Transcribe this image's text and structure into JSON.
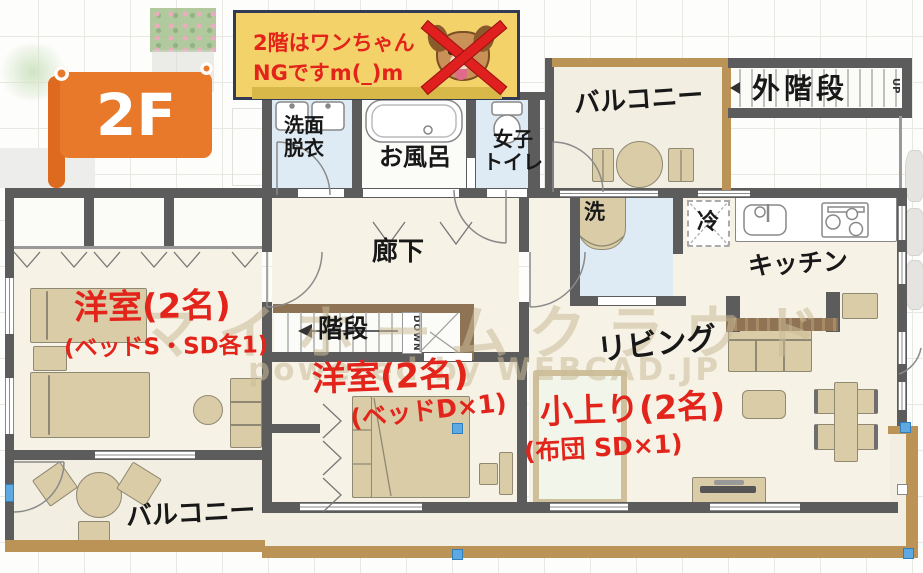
{
  "floor_banner": {
    "label": "2F"
  },
  "notice": {
    "line1": "2階はワンちゃん",
    "line2": "NGですm(_)m",
    "icon": "dog-face-crossed-out",
    "bg_color": "#F3D26A",
    "text_color": "#E2241B"
  },
  "watermark": {
    "brand": "マイホームクラウド",
    "powered_by": "powered by WEBCAD.JP"
  },
  "rooms": {
    "washroom": {
      "line1": "洗面",
      "line2": "脱衣"
    },
    "bath": {
      "label": "お風呂"
    },
    "toilet": {
      "line1": "女子",
      "line2": "トイレ"
    },
    "balcony_top": {
      "label": "バルコニー"
    },
    "outside_stairs": {
      "label": "外階段",
      "direction": "UP"
    },
    "corridor": {
      "label": "廊下"
    },
    "stairs": {
      "label": "階段",
      "direction": "DOWN"
    },
    "appliances": {
      "washer": "洗",
      "fridge": "冷"
    },
    "kitchen": {
      "label": "キッチン"
    },
    "living": {
      "label": "リビング"
    },
    "bedroom_a": {
      "label": "洋室(2名)",
      "detail": "(ベッドS・SD各1)"
    },
    "bedroom_b": {
      "label": "洋室(2名)",
      "detail": "(ベッドD×1)"
    },
    "koagari": {
      "label": "小上り(2名)",
      "detail": "(布団 SD×1)"
    },
    "balcony_bottom": {
      "label": "バルコニー"
    }
  },
  "colors": {
    "wall": "#5C5C5C",
    "floor": "#F7F2E6",
    "wet_floor": "#DEEBF4",
    "balcony_floor": "#F2EEE2",
    "balcony_trim": "#BB9357",
    "stair_rail": "#8F7355",
    "furniture": "#D9CCA6",
    "tatami_platform": "#F2F5E9",
    "accent_red": "#E2241B",
    "banner_orange": "#E8782A",
    "selection_blue": "#5FA9E2",
    "watermark": "#CBBC98"
  }
}
